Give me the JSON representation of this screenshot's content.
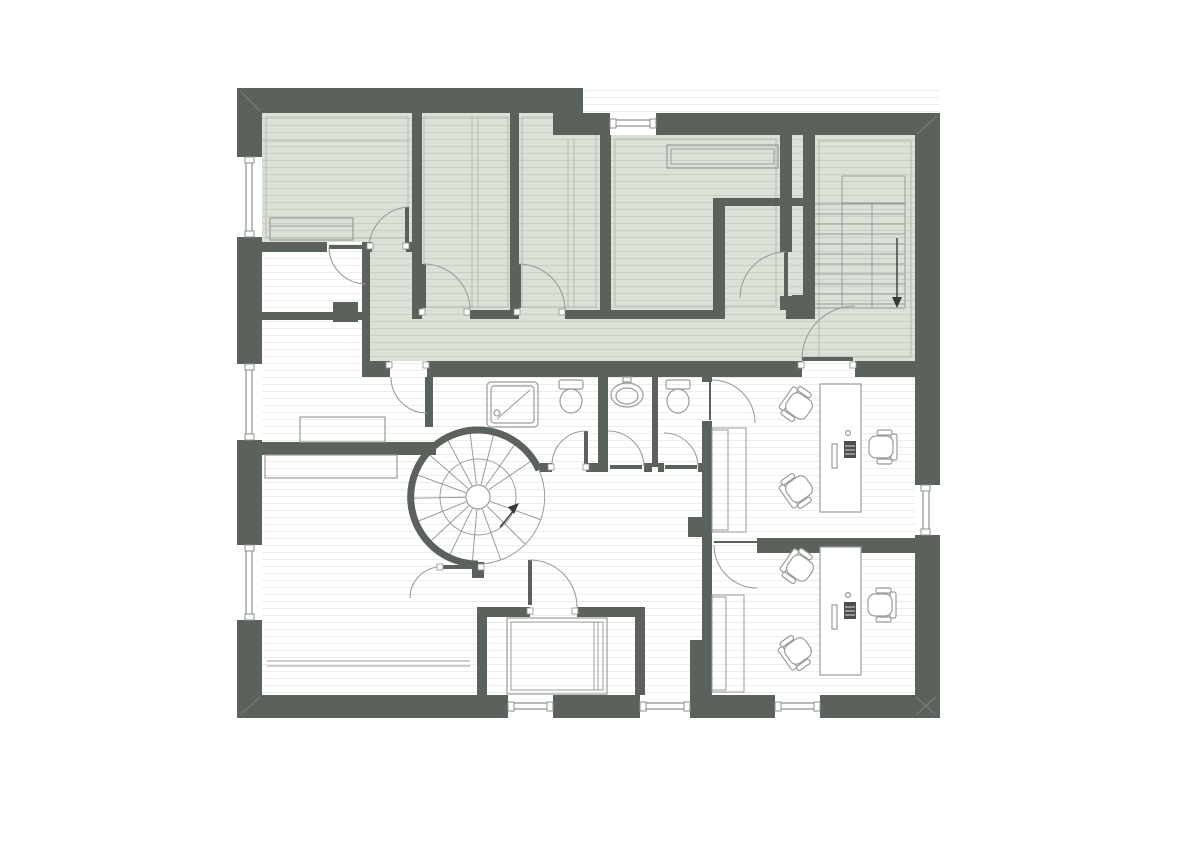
{
  "canvas": {
    "width": 1200,
    "height": 848
  },
  "colors": {
    "wall": "#5b615b",
    "wall_light": "#7b817b",
    "green_floor": "#dce1d8",
    "green_line": "#c9cfc5",
    "white_line": "#ededed",
    "fixture": "#9b9b9b",
    "door": "#9b9b9b",
    "inset": "#b4bab0",
    "glaze": "#8d928d",
    "radiator": "#474d47",
    "keyboard": "#4c4c4c",
    "arrow": "#3a3a3a"
  },
  "plan": {
    "type": "architectural-floor-plan",
    "text_labels": [],
    "zones": {
      "tinted_floor_zone": "upper band: three rooms, corridor and straight staircase hall (green-gray floorboards)",
      "plain_floor_zone": "lower band: left rooms, bathrooms, offices and small rooms (white floorboards)"
    },
    "inventory": {
      "windows": 8,
      "doors": 15,
      "spiral_staircase": 1,
      "straight_staircase": 1,
      "desks": 2,
      "office_chairs": 6,
      "monitors": 2,
      "keyboards": 2,
      "showers": 1,
      "toilets": 2,
      "sinks": 1,
      "radiators": 2,
      "wardrobes": 2,
      "tables_sideboards": 3
    },
    "stair_arrows": [
      {
        "stair": "straight-staircase",
        "direction": "down"
      },
      {
        "stair": "spiral-staircase",
        "direction": "up"
      }
    ]
  }
}
